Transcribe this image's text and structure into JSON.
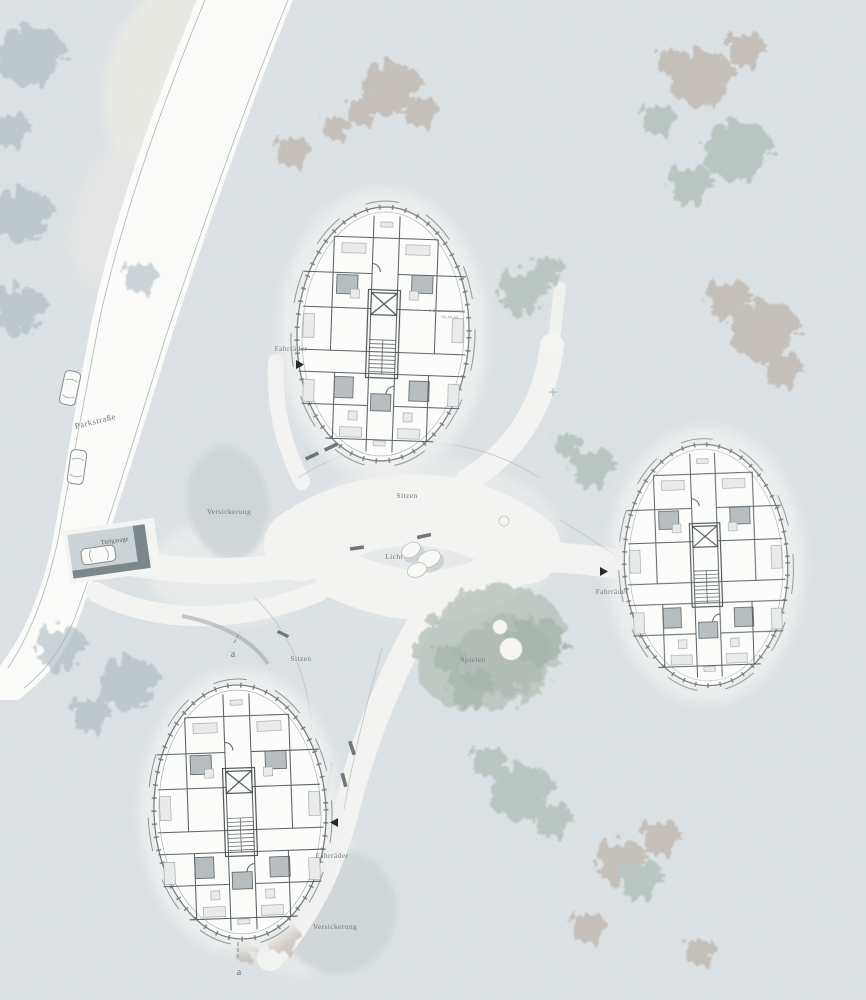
{
  "labels": {
    "street": "Parkstraße",
    "garage": "Tiefgarage",
    "infiltration_nw": "Versickerung",
    "infiltration_s": "Versickerung",
    "seating_center": "Sitzen",
    "seating_west": "Sitzen",
    "light": "Licht",
    "play": "Spielen",
    "bikes_north": "Fahrräder",
    "bikes_east": "Fahrräder",
    "bikes_south": "Fahrräder",
    "apartment_type": "4-Zimmerwohnung",
    "apartment_area": "96,40 m²",
    "section_top": "a",
    "section_bottom": "a"
  },
  "colors": {
    "background": "#e0e5e8",
    "road": "#fbfbfa",
    "path": "#f3f4f1",
    "building_fill": "#fcfcfa",
    "wall_line": "#5a6367",
    "bathroom_fill": "#b8bec0",
    "infiltration_fill": "#ccd2d5",
    "play_mound": "#b7c1ba",
    "tree_taupe": "#b2a498",
    "tree_green": "#9fb0a5",
    "tree_bluegray": "#a4b3ba",
    "garage_dark": "#7b878b",
    "label_text": "#73787a",
    "arrow": "#26292b"
  }
}
